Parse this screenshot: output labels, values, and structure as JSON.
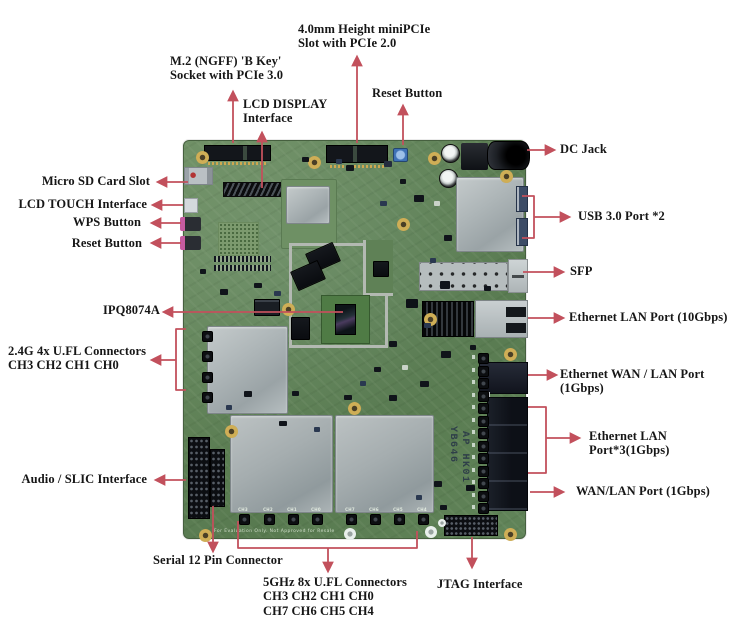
{
  "figure": {
    "type": "annotated-pcb-diagram",
    "accent_color": "#c2505c",
    "background": "#ffffff",
    "labels": {
      "minipcie": "4.0mm Height miniPCIe\nSlot with PCIe 2.0",
      "m2": "M.2 (NGFF) 'B Key'\nSocket with PCIe 3.0",
      "lcd_display": "LCD DISPLAY\nInterface",
      "reset_top": "Reset Button",
      "dc_jack": "DC Jack",
      "usb3": "USB 3.0 Port *2",
      "sfp": "SFP",
      "eth_10g": "Ethernet LAN Port (10Gbps)",
      "eth_wan_lan": "Ethernet WAN / LAN Port (1Gbps)",
      "eth_lan3": "Ethernet LAN Port*3(1Gbps)",
      "wan_lan": "WAN/LAN Port (1Gbps)",
      "micro_sd": "Micro SD Card Slot",
      "lcd_touch": "LCD TOUCH Interface",
      "wps": "WPS Button",
      "reset_left": "Reset Button",
      "ipq": "IPQ8074A",
      "ufl_24g": "2.4G 4x U.FL Connectors\nCH3 CH2 CH1 CH0",
      "audio_slic": "Audio / SLIC Interface",
      "serial_12pin": "Serial 12 Pin Connector",
      "ufl_5g": "5GHz 8x U.FL Connectors\nCH3 CH2 CH1 CH0\nCH7 CH6 CH5 CH4",
      "jtag": "JTAG Interface"
    },
    "board": {
      "model_line_1": "YB646",
      "model_line_2": "AP HK01",
      "silkscreen_note": "For Evaluation Only. Not Approved for Resale",
      "channel_labels_bottom": [
        "CH3",
        "CH2",
        "CH1",
        "CH0",
        "CH7",
        "CH6",
        "CH5",
        "CH4"
      ]
    }
  }
}
